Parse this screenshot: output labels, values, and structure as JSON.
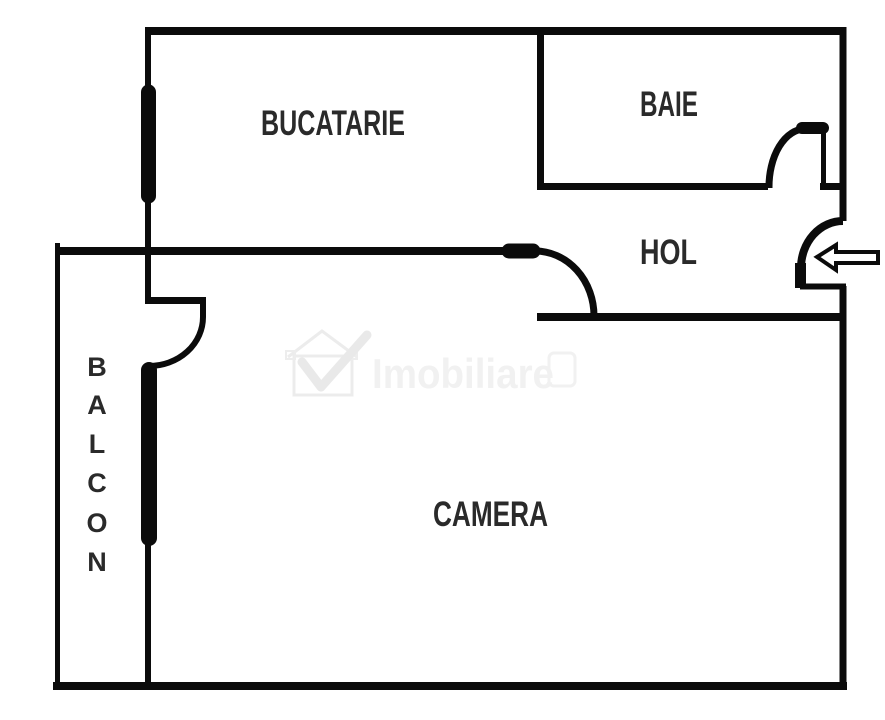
{
  "title": "Apartment floor plan",
  "rooms": {
    "kitchen": {
      "label": "BUCATARIE"
    },
    "bathroom": {
      "label": "BAIE"
    },
    "hallway": {
      "label": "HOL"
    },
    "living_room": {
      "label": "CAMERA"
    },
    "balcony": {
      "label": "BALCON",
      "letters": [
        "B",
        "A",
        "L",
        "C",
        "O",
        "N"
      ]
    }
  },
  "watermark": {
    "brand": "Imobiliare"
  },
  "entrance": {
    "direction": "left"
  },
  "colors": {
    "wall": "#0b0b0b",
    "label": "#2a2a2a",
    "watermark": "#f1f1f1",
    "background": "#ffffff"
  }
}
